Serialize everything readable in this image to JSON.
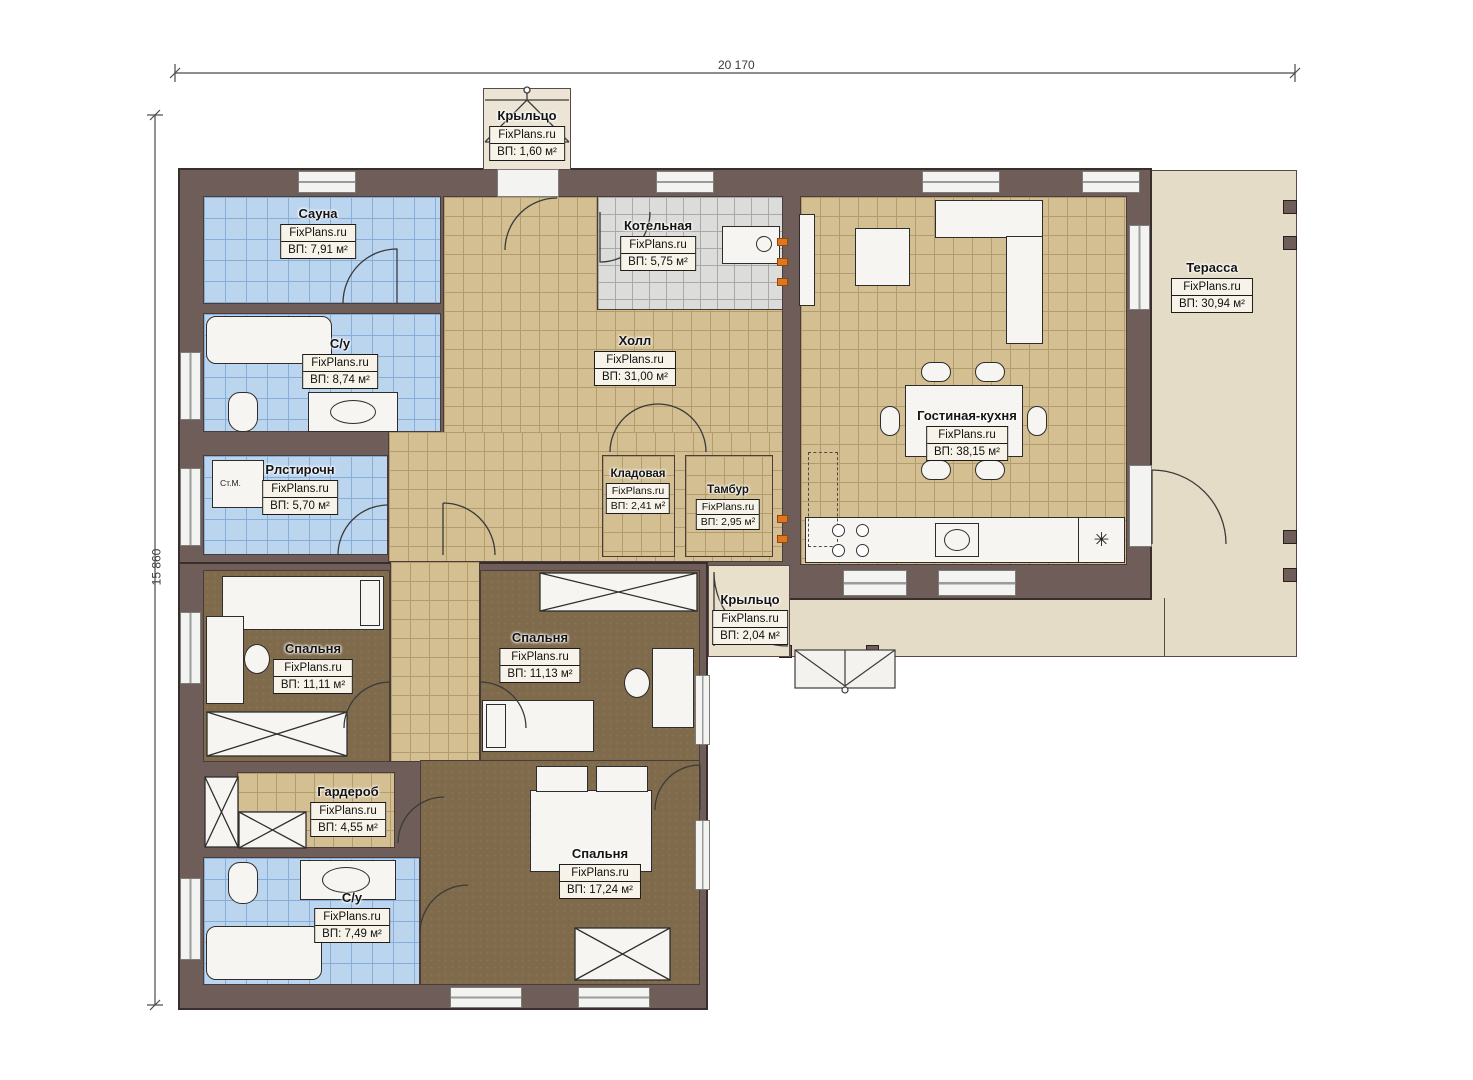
{
  "meta": {
    "brand": "FixPlans.ru"
  },
  "dimensions": {
    "width_label": "20 170",
    "height_label": "15 860"
  },
  "rooms": {
    "kryltso_top": {
      "name": "Крыльцо",
      "area": "ВП: 1,60 м²"
    },
    "sauna": {
      "name": "Сауна",
      "area": "ВП: 7,91 м²"
    },
    "su1": {
      "name": "С/у",
      "area": "ВП: 8,74 м²"
    },
    "kotelnaya": {
      "name": "Котельная",
      "area": "ВП: 5,75 м²"
    },
    "holl": {
      "name": "Холл",
      "area": "ВП: 31,00 м²"
    },
    "gostinaya": {
      "name": "Гостиная-кухня",
      "area": "ВП: 38,15 м²"
    },
    "terrassa": {
      "name": "Терасса",
      "area": "ВП: 30,94 м²"
    },
    "postirochnaya": {
      "name": "Рлстирочн",
      "area": "ВП: 5,70 м²"
    },
    "kladovaya": {
      "name": "Кладовая",
      "area": "ВП: 2,41 м²"
    },
    "tambur": {
      "name": "Тамбур",
      "area": "ВП: 2,95 м²"
    },
    "kryltso_bottom": {
      "name": "Крыльцо",
      "area": "ВП: 2,04 м²"
    },
    "spalnya1": {
      "name": "Спальня",
      "area": "ВП: 11,11 м²"
    },
    "spalnya2": {
      "name": "Спальня",
      "area": "ВП: 11,13 м²"
    },
    "garderob": {
      "name": "Гардероб",
      "area": "ВП: 4,55 м²"
    },
    "su2": {
      "name": "С/у",
      "area": "ВП: 7,49 м²"
    },
    "spalnya3": {
      "name": "Спальня",
      "area": "ВП: 17,24 м²"
    }
  },
  "annotations": {
    "washer_label": "Ст.М.",
    "fridge_symbol": "✳"
  },
  "colors": {
    "wall": "#6f5d5a",
    "tile_blue": "#bcd5ef",
    "tile_tan": "#d3bf92",
    "tile_gray": "#dcdcda",
    "floor_brown": "#7f6a4c",
    "terrace": "#e5dcc7",
    "radiator": "#e2761e"
  }
}
